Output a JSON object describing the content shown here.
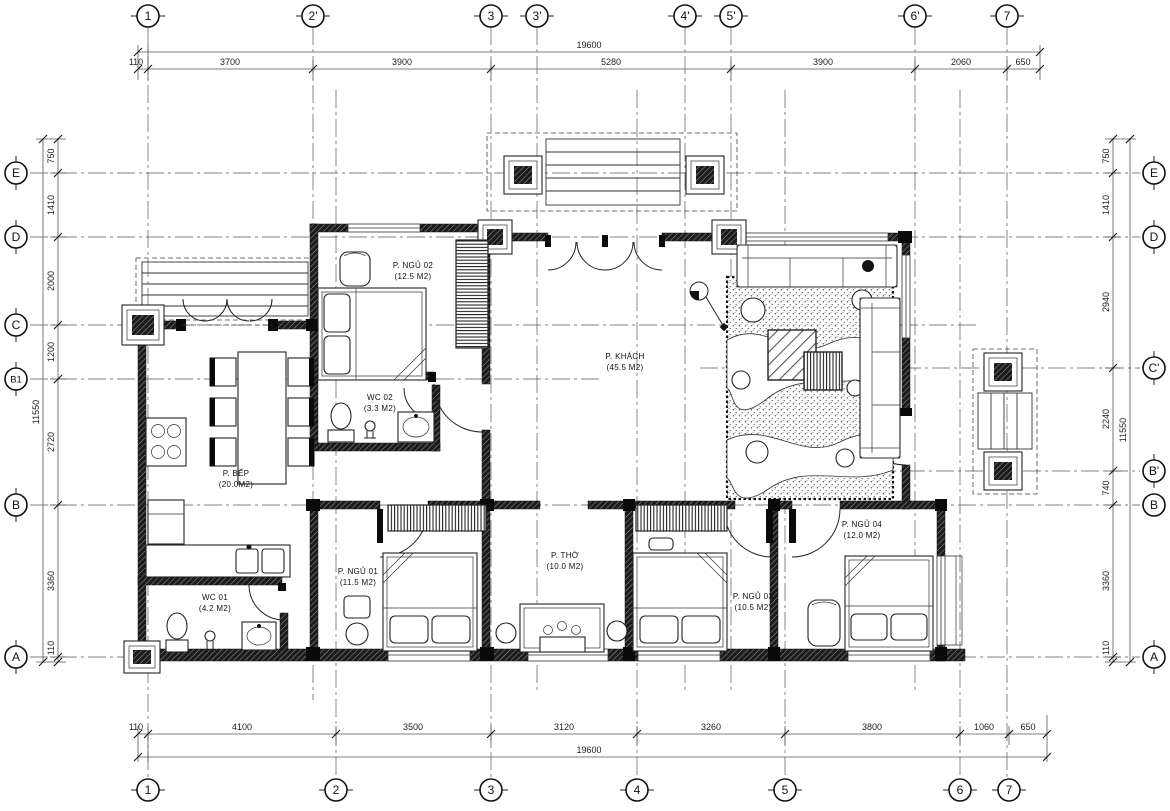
{
  "drawing": {
    "type_label": "ground-floor-plan"
  },
  "grid": {
    "top": [
      "1",
      "2'",
      "3",
      "3'",
      "4'",
      "5'",
      "6'",
      "7"
    ],
    "bottom": [
      "1",
      "2",
      "3",
      "4",
      "5",
      "6",
      "7"
    ],
    "left": [
      "E",
      "D",
      "C",
      "B1",
      "B",
      "A"
    ],
    "right": [
      "E",
      "D",
      "C'",
      "B'",
      "B",
      "A"
    ]
  },
  "dims": {
    "top": {
      "total": "19600",
      "segments": [
        "110",
        "3700",
        "3900",
        "5280",
        "3900",
        "2060",
        "650"
      ]
    },
    "bottom": {
      "total": "19600",
      "segments": [
        "110",
        "4100",
        "3500",
        "3120",
        "3260",
        "3800",
        "1060",
        "650"
      ]
    },
    "left": {
      "total": "11550",
      "segments": [
        "750",
        "1410",
        "2000",
        "1200",
        "2720",
        "3360",
        "110"
      ]
    },
    "right": {
      "total": "11550",
      "segments": [
        "750",
        "1410",
        "2940",
        "2240",
        "740",
        "3360",
        "110"
      ]
    }
  },
  "rooms": {
    "ngu02": {
      "name": "P. NGỦ 02",
      "area": "(12.5 M2)"
    },
    "wc02": {
      "name": "WC 02",
      "area": "(3.3 M2)"
    },
    "khach": {
      "name": "P. KHÁCH",
      "area": "(45.5 M2)"
    },
    "bep": {
      "name": "P. BẾP",
      "area": "(20.0M2)"
    },
    "wc01": {
      "name": "WC 01",
      "area": "(4.2 M2)"
    },
    "ngu01": {
      "name": "P. NGỦ 01",
      "area": "(11.5 M2)"
    },
    "tho": {
      "name": "P. THỜ",
      "area": "(10.0 M2)"
    },
    "ngu03": {
      "name": "P. NGỦ 03",
      "area": "(10.5 M2)"
    },
    "ngu04": {
      "name": "P. NGỦ 04",
      "area": "(12.0 M2)"
    }
  },
  "colors": {
    "line": "#111111",
    "dim": "#222222",
    "wall_hatch": "#1c1c1c",
    "background": "#ffffff"
  }
}
